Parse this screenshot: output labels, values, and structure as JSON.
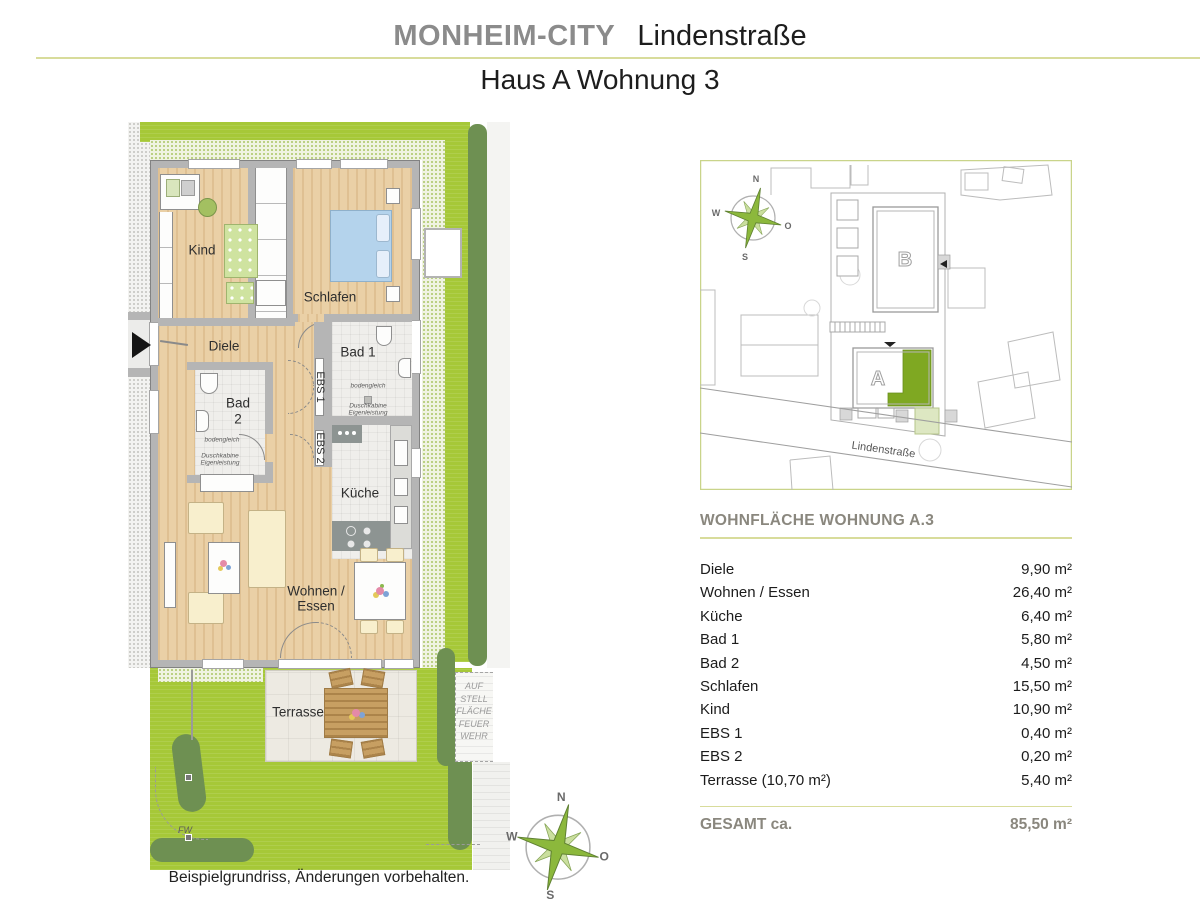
{
  "header": {
    "brand": "MONHEIM-CITY",
    "project": "Lindenstraße",
    "subtitle": "Haus A Wohnung 3"
  },
  "floorplan": {
    "rooms": {
      "kind": "Kind",
      "schlafen": "Schlafen",
      "diele": "Diele",
      "bad1": "Bad 1",
      "bad2a": "Bad",
      "bad2b": "2",
      "ebs1": "EBS 1",
      "ebs2": "EBS 2",
      "kueche": "Küche",
      "wohnen1": "Wohnen /",
      "wohnen2": "Essen",
      "terrasse": "Terrasse"
    },
    "bad1_notes": {
      "l1": "bodengleich",
      "l2": "Duschkabine",
      "l3": "Eigenleistung"
    },
    "bad2_notes": {
      "l1": "bodengleich",
      "l2": "Duschkabine",
      "l3": "Eigenleistung"
    },
    "feuerwehr": {
      "l1": "AUF",
      "l2": "STELL",
      "l3": "FLÄCHE",
      "l4": "FEUER",
      "l5": "WEHR"
    },
    "fw_label": "FW",
    "caption": "Beispielgrundriss, Änderungen vorbehalten."
  },
  "compass": {
    "n": "N",
    "o": "O",
    "s": "S",
    "w": "W"
  },
  "siteplan": {
    "building_a": "A",
    "building_b": "B",
    "street": "Lindenstraße"
  },
  "area_table": {
    "title": "WOHNFLÄCHE WOHNUNG A.3",
    "rows": [
      {
        "label": "Diele",
        "value": "9,90 m²"
      },
      {
        "label": "Wohnen / Essen",
        "value": "26,40 m²"
      },
      {
        "label": "Küche",
        "value": "6,40 m²"
      },
      {
        "label": "Bad 1",
        "value": "5,80 m²"
      },
      {
        "label": "Bad 2",
        "value": "4,50 m²"
      },
      {
        "label": "Schlafen",
        "value": "15,50 m²"
      },
      {
        "label": "Kind",
        "value": "10,90 m²"
      },
      {
        "label": "EBS 1",
        "value": "0,40 m²"
      },
      {
        "label": "EBS 2",
        "value": "0,20 m²"
      },
      {
        "label": "Terrasse (10,70 m²)",
        "value": "5,40 m²"
      }
    ],
    "total_label": "GESAMT ca.",
    "total_value": "85,50 m²"
  },
  "colors": {
    "accent_green": "#a6c838",
    "hedge_green": "#6e9052",
    "highlight_green": "#7fa822",
    "line_olive": "#d8dc9b",
    "title_gray": "#8b8b8b"
  }
}
